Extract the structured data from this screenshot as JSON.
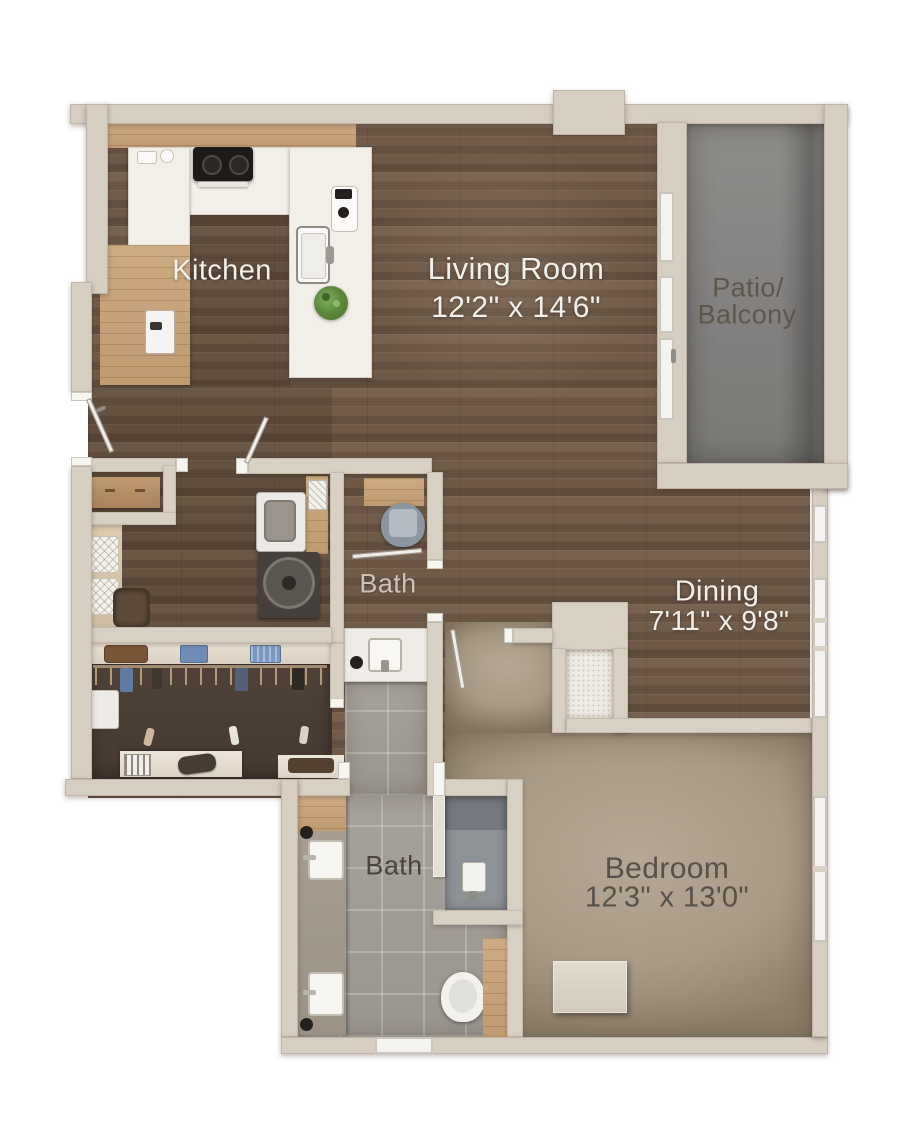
{
  "plan": {
    "type": "apartment floor plan (top-down 3D rendering)",
    "background": "#ffffff"
  },
  "rooms": {
    "kitchen": {
      "name": "Kitchen"
    },
    "living_room": {
      "name": "Living Room",
      "dimensions": "12'2\" x 14'6\""
    },
    "patio_balcony": {
      "name_line1": "Patio/",
      "name_line2": "Balcony"
    },
    "bath_upper": {
      "name": "Bath"
    },
    "dining": {
      "name": "Dining",
      "dimensions": "7'11\" x 9'8\""
    },
    "bedroom": {
      "name": "Bedroom",
      "dimensions": "12'3\" x 13'0\""
    },
    "bath_lower": {
      "name": "Bath"
    }
  },
  "colors": {
    "wall": "#d7cec2",
    "door_jamb_white": "#f7f5f0",
    "wood_floor_dark": "#6b5746",
    "wood_counter_light": "#c5a37b",
    "counter_white": "#f2efe9",
    "patio_concrete": "#8b8987",
    "bedroom_carpet": "#aca08c",
    "bath_tile": "#a29d96",
    "closet_floor": "#4a3d33",
    "label_light": "#f3f0ea",
    "label_dark": "#57514b",
    "plant_green": "#5e8a3f",
    "appliance_black": "#1d1b19"
  },
  "fixtures": [
    "cooktop",
    "kitchen island",
    "island sink",
    "coffee maker",
    "potted plant",
    "console table",
    "ottoman cushions",
    "storage basket",
    "dryer",
    "washing machine",
    "toilet",
    "wood shelf",
    "vanity sink",
    "closet shelf with bins",
    "clothes hangers",
    "laundry hamper",
    "shoe bench",
    "duffel bag",
    "double vanity",
    "walk-in shower",
    "shower head",
    "wood cabinet",
    "dresser",
    "sliding glass doors",
    "windows",
    "swing doors"
  ]
}
